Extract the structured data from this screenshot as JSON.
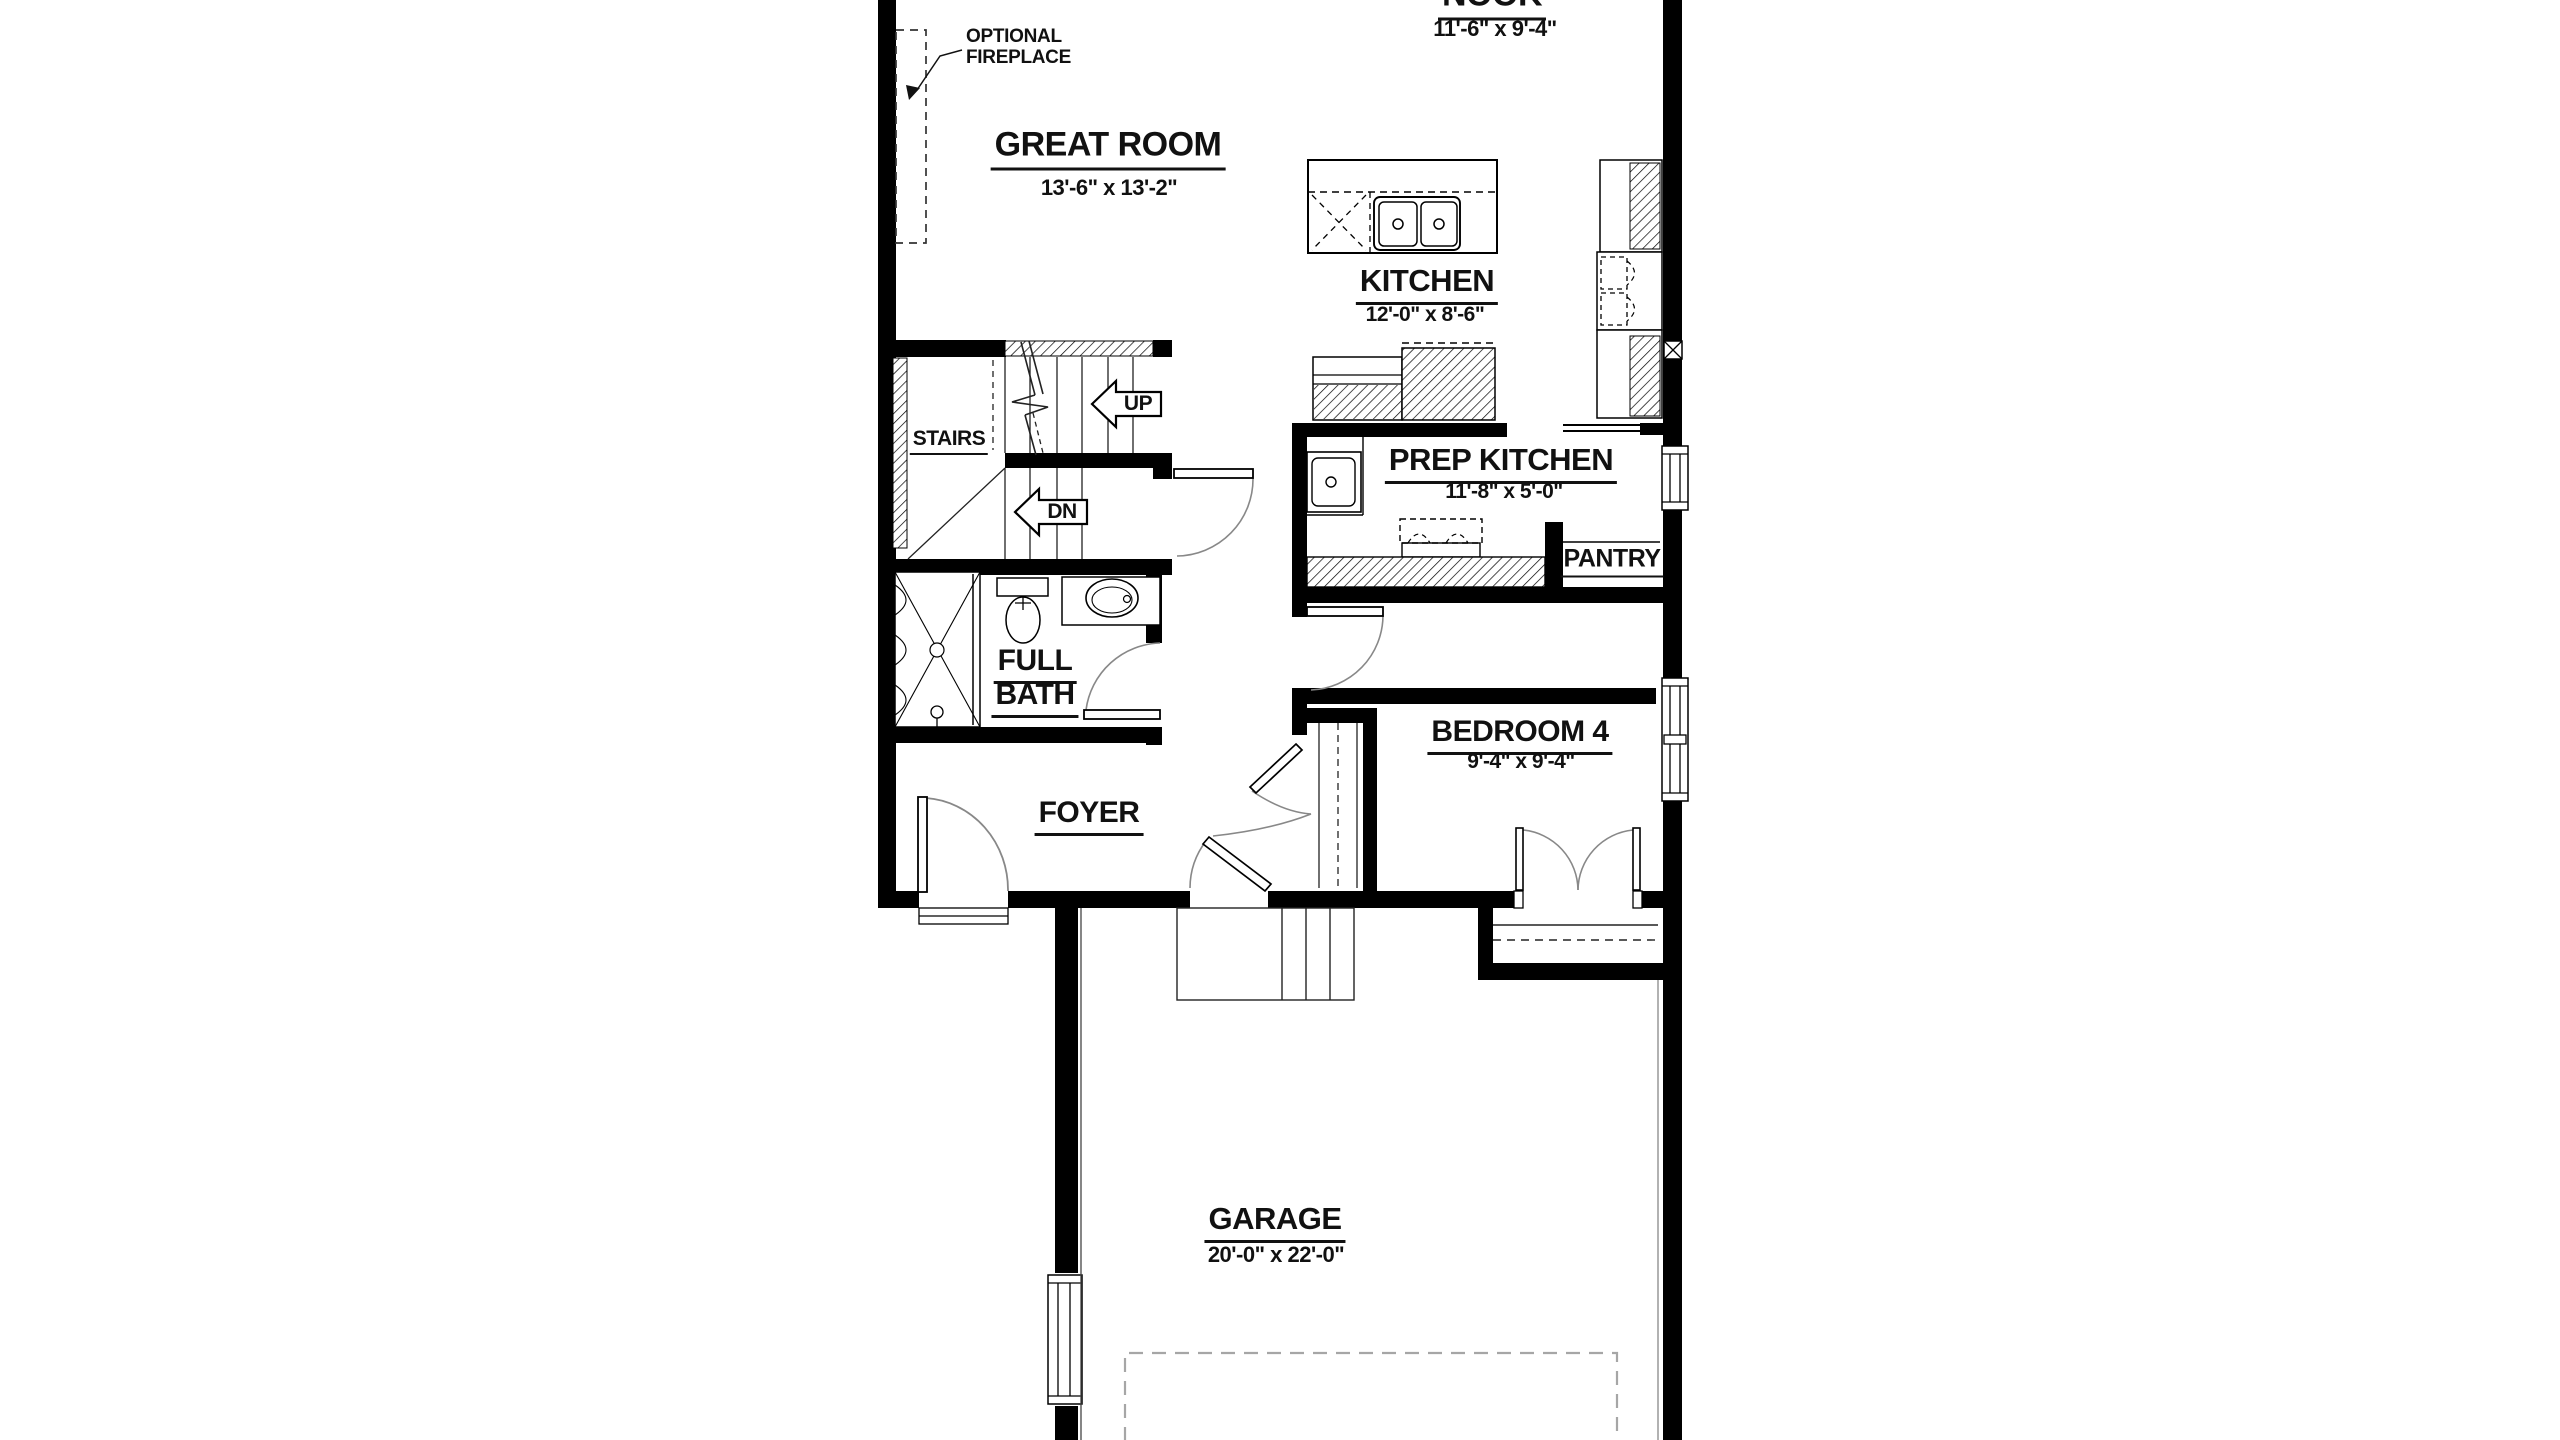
{
  "document": {
    "type": "architectural-floor-plan",
    "floor": "main"
  },
  "rooms": {
    "nook": {
      "name": "NOOK",
      "dims": "11'-6\" x 9'-4\""
    },
    "great_room": {
      "name": "GREAT ROOM",
      "dims": "13'-6\" x 13'-2\""
    },
    "kitchen": {
      "name": "KITCHEN",
      "dims": "12'-0\" x 8'-6\""
    },
    "prep_kitchen": {
      "name": "PREP KITCHEN",
      "dims": "11'-8\" x 5'-0\""
    },
    "pantry": {
      "name": "PANTRY"
    },
    "stairs": {
      "name": "STAIRS"
    },
    "full_bath": {
      "name_line1": "FULL",
      "name_line2": "BATH"
    },
    "bedroom_4": {
      "name": "BEDROOM 4",
      "dims": "9'-4\" x 9'-4\""
    },
    "foyer": {
      "name": "FOYER"
    },
    "garage": {
      "name": "GARAGE",
      "dims": "20'-0\" x 22'-0\""
    }
  },
  "annotations": {
    "optional_fireplace_line1": "OPTIONAL",
    "optional_fireplace_line2": "FIREPLACE",
    "stair_up": "UP",
    "stair_down": "DN"
  },
  "colors": {
    "background": "#ffffff",
    "walls": "#000000",
    "text": "#111111",
    "door_arc": "#888888",
    "parking_dash": "#a6a6a6"
  }
}
